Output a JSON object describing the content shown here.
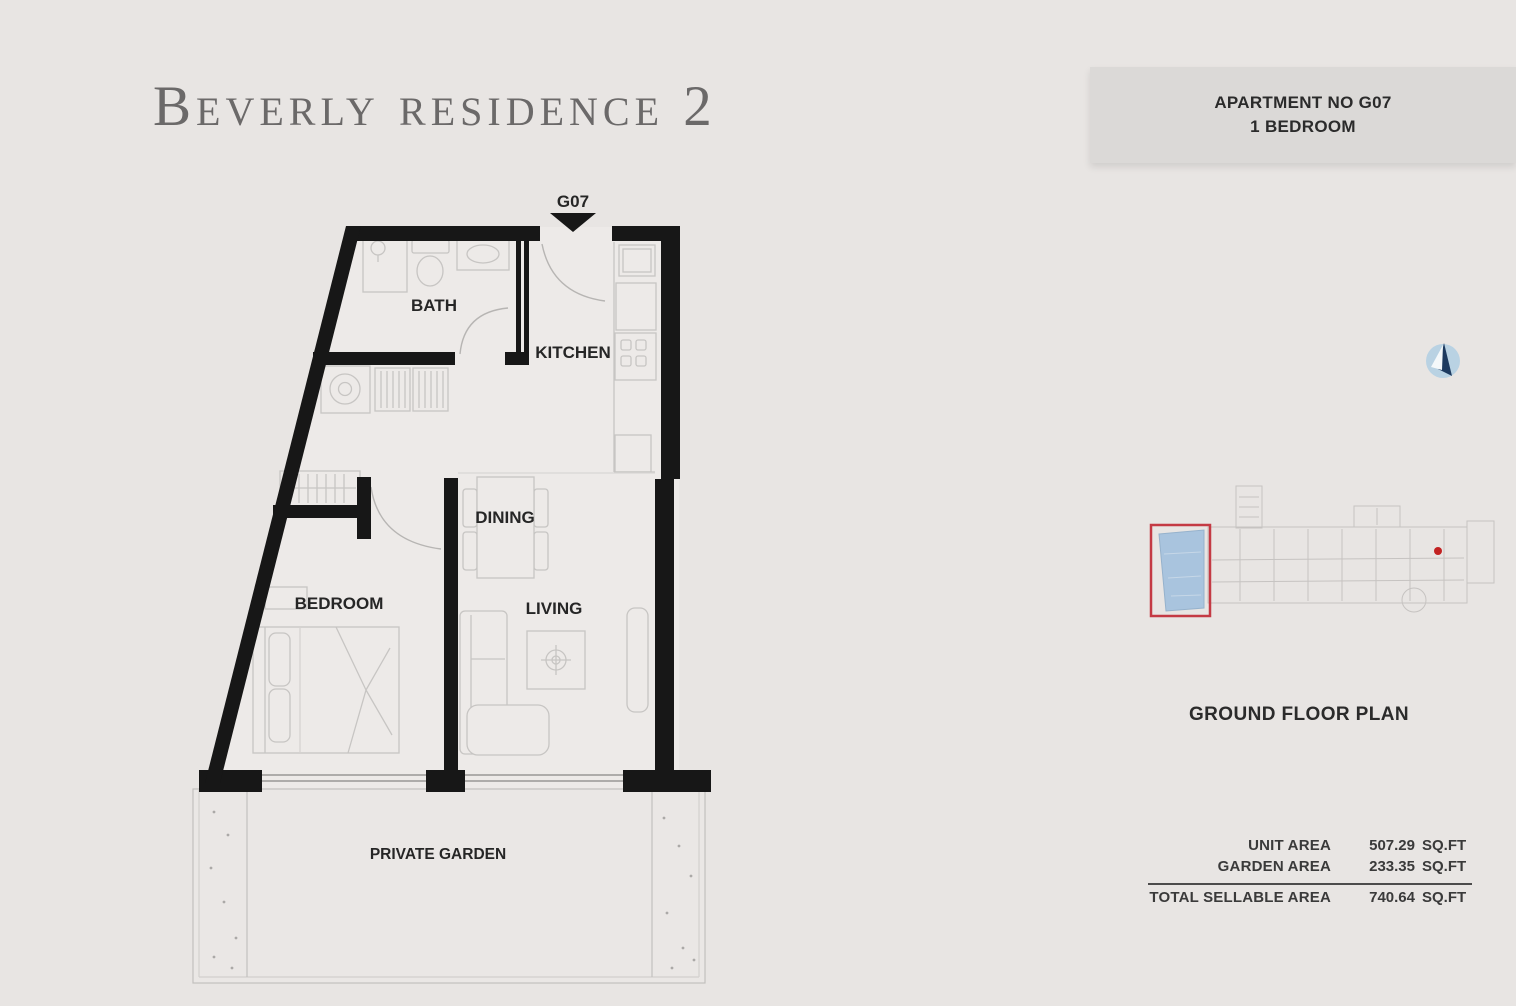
{
  "page_title": "Beverly residence 2",
  "unit_info": {
    "apartment_no": "APARTMENT NO G07",
    "bedrooms": "1 BEDROOM"
  },
  "plan": {
    "entrance_label": "G07",
    "room_labels": {
      "bath": "BATH",
      "kitchen": "KITCHEN",
      "dining": "DINING",
      "bedroom": "BEDROOM",
      "living": "LIVING",
      "garden": "PRIVATE GARDEN"
    }
  },
  "locator": {
    "caption": "GROUND FLOOR PLAN",
    "highlighted_unit": "G07"
  },
  "area_table": {
    "rows": [
      {
        "label": "UNIT AREA",
        "value": "507.29",
        "unit": "SQ.FT"
      },
      {
        "label": "GARDEN AREA",
        "value": "233.35",
        "unit": "SQ.FT"
      },
      {
        "label": "TOTAL SELLABLE AREA",
        "value": "740.64",
        "unit": "SQ.FT"
      }
    ]
  },
  "colors": {
    "background": "#e8e5e3",
    "panel": "#dbd9d7",
    "wall": "#171717",
    "furniture_line": "#c7c5c3",
    "accent_red": "#c43a44",
    "accent_blue": "#a9c4de",
    "text_dark": "#2b2b2b",
    "title_grey": "#6b6969"
  }
}
